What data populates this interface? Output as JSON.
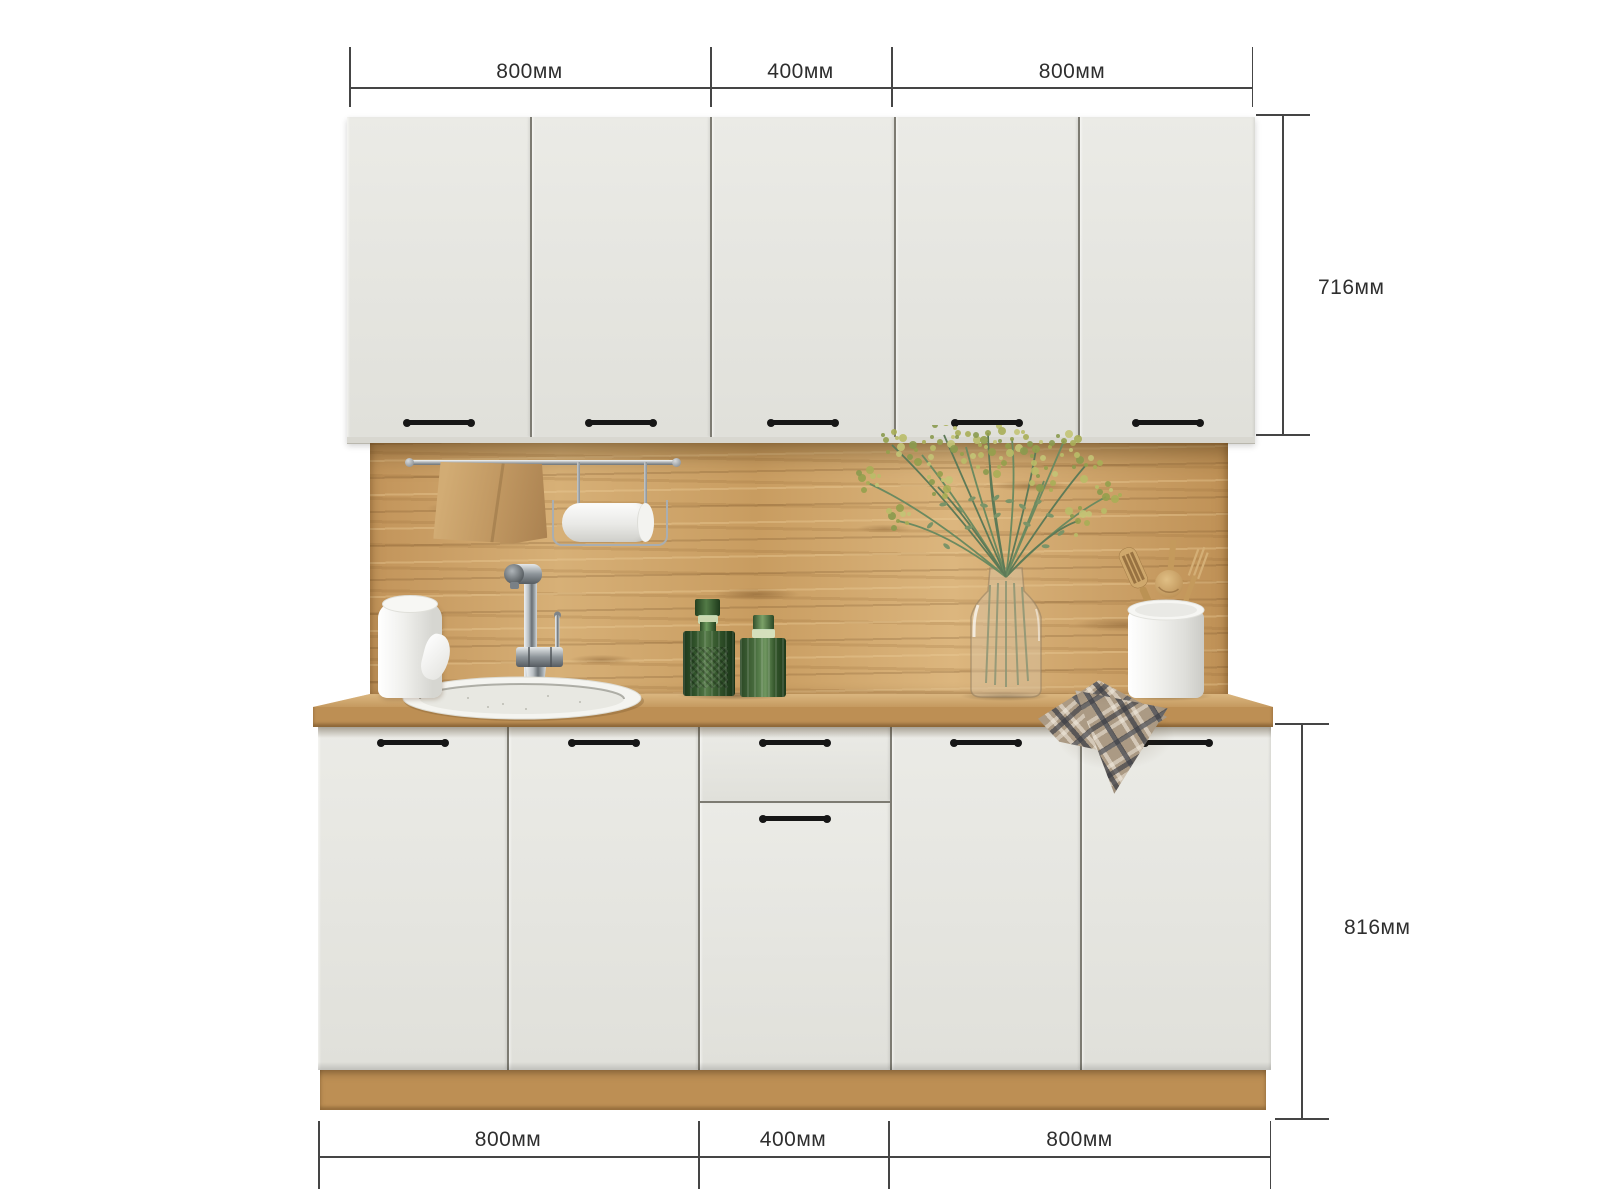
{
  "title": "Kitchen set front elevation with dimensions",
  "dimensions": {
    "top": {
      "segments": [
        "800мм",
        "400мм",
        "800мм"
      ]
    },
    "bottom": {
      "segments": [
        "800мм",
        "400мм",
        "800мм"
      ]
    },
    "upper_cabinet_height": "716мм",
    "lower_cabinet_height": "816мм"
  },
  "colors": {
    "background": "#ffffff",
    "door": "#e7e7e2",
    "door_gap": "#7d7b72",
    "handle": "#161616",
    "wood_backsplash": "#c99e63",
    "wood_countertop": "#bd8f54",
    "dimension_line": "#454545",
    "dimension_text": "#2e2e2e",
    "bottle_green": "#3a5d31",
    "towel_tan": "#c09761",
    "plaid_beige": "#ab9a84"
  },
  "scene": {
    "upper_doors": 5,
    "lower_layout": [
      "door",
      "door",
      "drawer-over-door",
      "door",
      "door"
    ],
    "decor_items": [
      "wall-rail",
      "tan-kitchen-towel",
      "paper-towel-holder",
      "paper-towel-roll",
      "chrome-faucet",
      "round-inset-sink",
      "green-glass-decanter",
      "green-glass-decanter",
      "glass-vase-with-greenery",
      "utensil-crock",
      "wooden-utensils",
      "plaid-towel"
    ]
  }
}
